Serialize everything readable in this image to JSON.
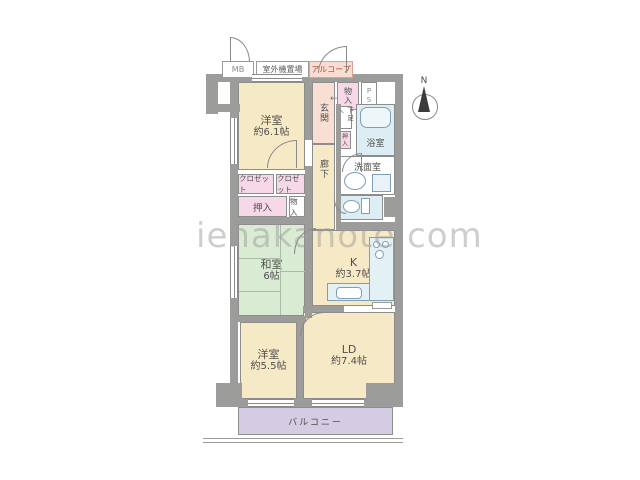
{
  "watermark": "ienakanote.com",
  "compass": {
    "north_label": "N"
  },
  "exterior": {
    "meter_box": "MB",
    "outdoor_unit_area": "室外機置場",
    "alcove": "アルコープ",
    "balcony": "バルコニー"
  },
  "rooms": {
    "western_room_1": {
      "name": "洋室",
      "size": "約6.1帖"
    },
    "western_room_2": {
      "name": "洋室",
      "size": "約5.5帖"
    },
    "japanese_room": {
      "name": "和室",
      "size": "6帖"
    },
    "living_dining": {
      "name": "LD",
      "size": "約7.4帖"
    },
    "kitchen": {
      "name": "K",
      "size": "約3.7帖"
    },
    "entrance": "玄関",
    "hallway": "廊下",
    "bathroom": "浴室",
    "washroom": "洗面室"
  },
  "storage": {
    "storage_entrance": "物入",
    "pipe_space": "PS",
    "shoe_cabinet": "下足入",
    "oshiire_small": "押入",
    "closet_1": "クロゼット",
    "closet_2": "クロゼット",
    "oshiire": "押入",
    "storage_2": "物入"
  },
  "annotations": {
    "entrance_arrow": "←"
  },
  "colors": {
    "wall": "#9c9c9a",
    "room_cream": "#f6e9c6",
    "tatami_green": "#d9ecd3",
    "water_blue": "#dcedf4",
    "closet_pink": "#f7d8e8",
    "entrance_peach": "#f9ded3",
    "balcony_lavender": "#d4cce3",
    "alcove_accent": "#a05048",
    "fixture_stroke": "#7fa0b4"
  }
}
